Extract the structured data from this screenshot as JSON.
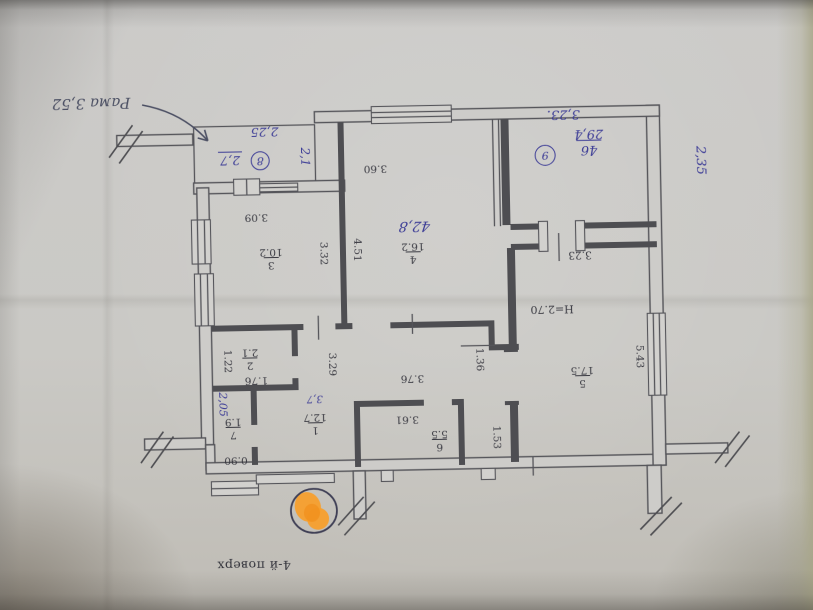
{
  "plan": {
    "caption": "4-й поверх",
    "rooms": {
      "r1": {
        "num": "1",
        "area": "12.7"
      },
      "r2": {
        "num": "2",
        "area": "2.1"
      },
      "r3": {
        "num": "3",
        "area": "10.2"
      },
      "r4": {
        "num": "4",
        "area": "16.2"
      },
      "r5": {
        "num": "5",
        "area": "17.5"
      },
      "r6": {
        "num": "6",
        "area": "5.5"
      },
      "r7": {
        "num": "7",
        "area": "1.9"
      }
    },
    "dims": {
      "room3_top": "3.09",
      "room3_right": "3.32",
      "room4_left": "4.51",
      "room4_top": "3.60",
      "room2_left": "1.22",
      "room2_bottom": "1.76",
      "hall_width": "3.29",
      "room7_bottom": "0.90",
      "hall_top": "3.76",
      "room6_top": "3.61",
      "pass_width": "1.36",
      "pass_height": "1.53",
      "room5_nook": "3.23",
      "room5_right": "5.43",
      "ceiling_height": "H=2.70"
    }
  },
  "handwriting": {
    "note_frame": "Рама 3,52",
    "balcony_width": "2,25",
    "balcony_mark": "8",
    "balcony_area": "2,7",
    "balcony_side": "2,1",
    "room4_area": "42,8",
    "tr_room_dim": "3,23.",
    "tr_room_mark": "9",
    "area_total": "46",
    "area_living": "29,4",
    "tr_room_side": "2,35",
    "hall_note": "2,05",
    "hall_area": "3,7"
  }
}
